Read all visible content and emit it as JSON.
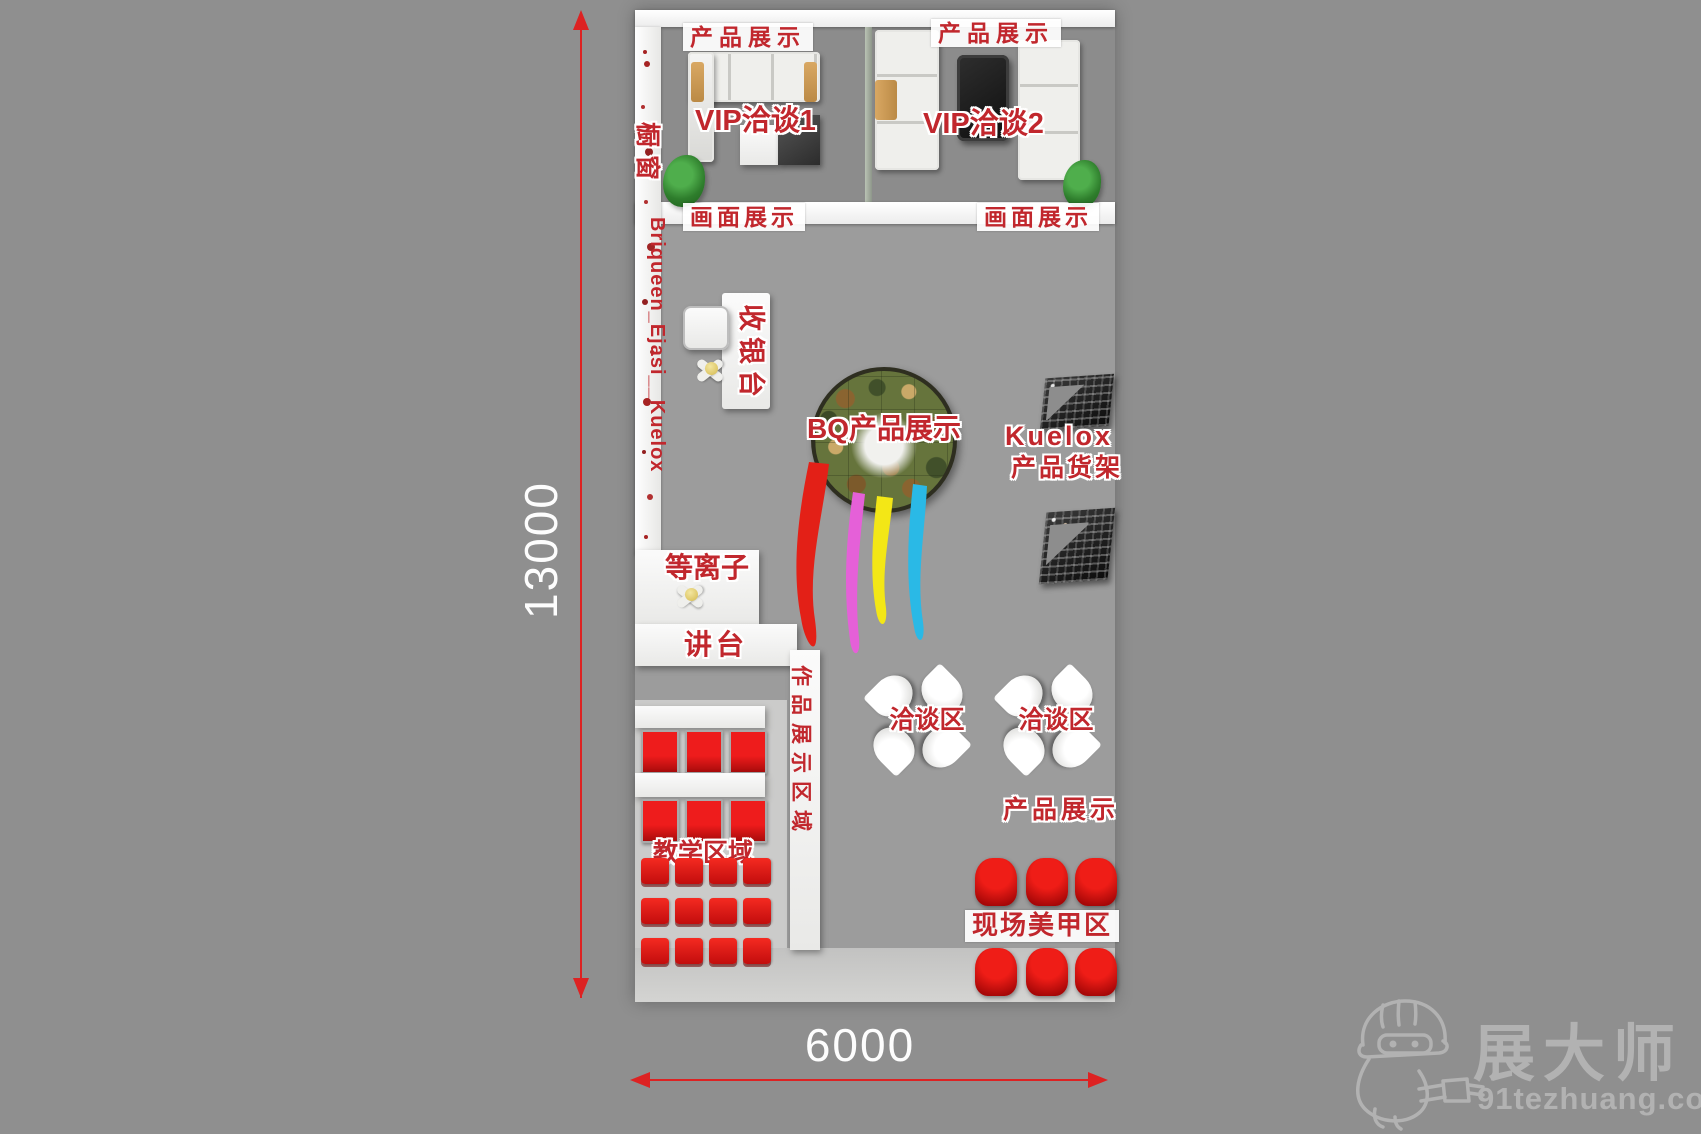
{
  "dimensions": {
    "height_label": "13000",
    "width_label": "6000"
  },
  "plan": {
    "vip": {
      "product_display_left": "产品展示",
      "product_display_right": "产品展示",
      "room1": "VIP洽谈1",
      "room2": "VIP洽谈2",
      "picture_display_left": "画面展示",
      "picture_display_right": "画面展示"
    },
    "left_wall": {
      "window_label": "橱窗",
      "brands": "Briqueen_Ejasi__Kuelox"
    },
    "cashier": "收银台",
    "center_display": "BQ产品展示",
    "kuelox": {
      "brand": "Kuelox",
      "shelf": "产品货架"
    },
    "plasma": "等离子",
    "podium": "讲台",
    "negotiation": {
      "area1": "洽谈区",
      "area2": "洽谈区"
    },
    "teaching_area": "教学区域",
    "works_panel": "作品展示区域",
    "product_display_bottom": "产品展示",
    "nail_area": "现场美甲区"
  },
  "watermark": {
    "brand": "展大师",
    "site": "91tezhuang.com"
  },
  "colors": {
    "background_gray": "#8f8f8f",
    "label_red": "#c1272d",
    "dimension_red": "#dd2222",
    "chair_red": "#e21313",
    "wall_white": "#f7f7f7",
    "watermark_gray": "#b2b2b2",
    "drip_red": "#e32017",
    "drip_magenta": "#e560d8",
    "drip_yellow": "#f3e716",
    "drip_cyan": "#2ab9e6"
  }
}
